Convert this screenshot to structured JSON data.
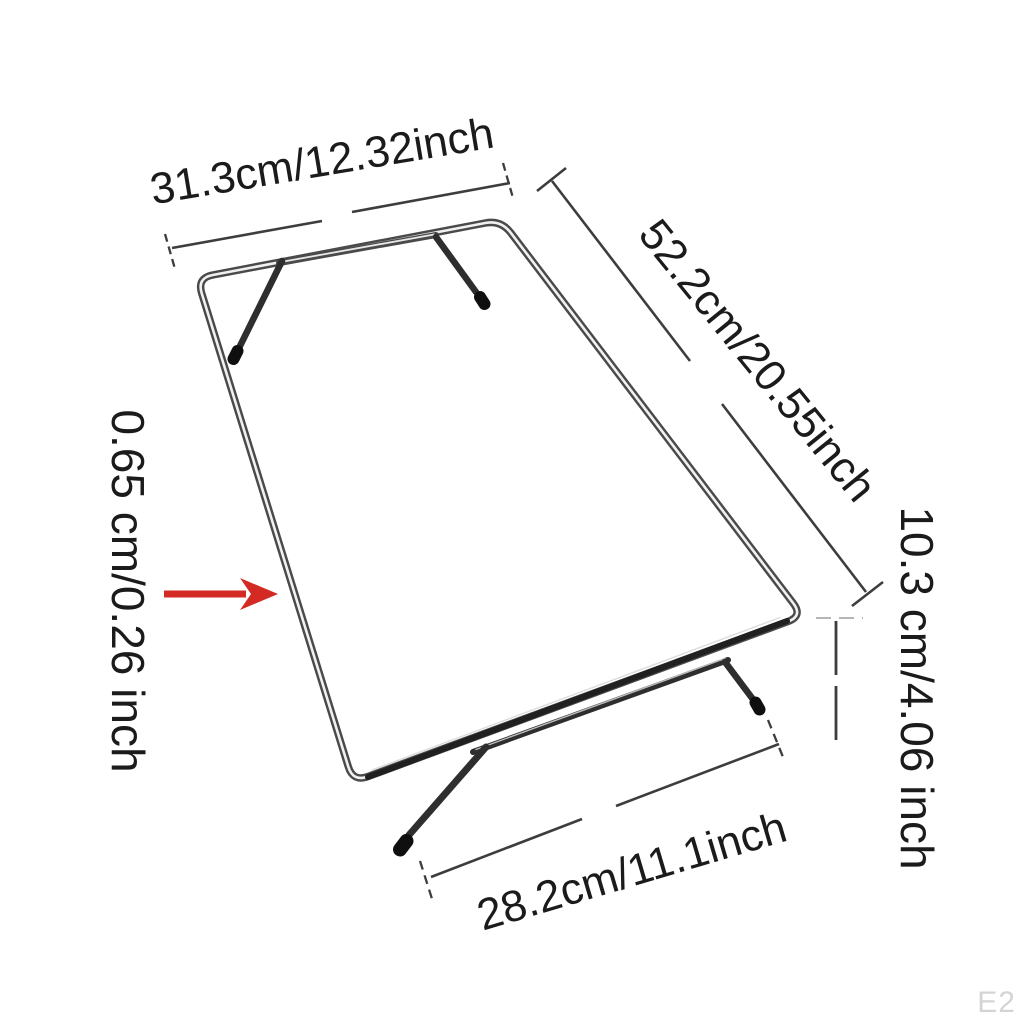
{
  "diagram": {
    "background": "#ffffff",
    "labels": {
      "top_width": "31.3cm/12.32inch",
      "depth": "52.2cm/20.55inch",
      "thickness": "0.65 cm/0.26 inch",
      "height": "10.3 cm/4.06 inch",
      "bottom_width": "28.2cm/11.1inch"
    },
    "watermark": "E2",
    "colors": {
      "label_text": "#1b1b1b",
      "dimension_line": "#3d3d3d",
      "height_guide_light": "#b5b5b5",
      "arrow_red": "#d32b23",
      "frame_metal_dark": "#4a4a4a",
      "frame_leg_dark": "#2e2e2e",
      "frame_highlight": "#f1f1f1",
      "frame_front_dark": "#202020",
      "foot_cap_black": "#0f0f0f",
      "watermark_gray": "#d4d4d4"
    }
  }
}
